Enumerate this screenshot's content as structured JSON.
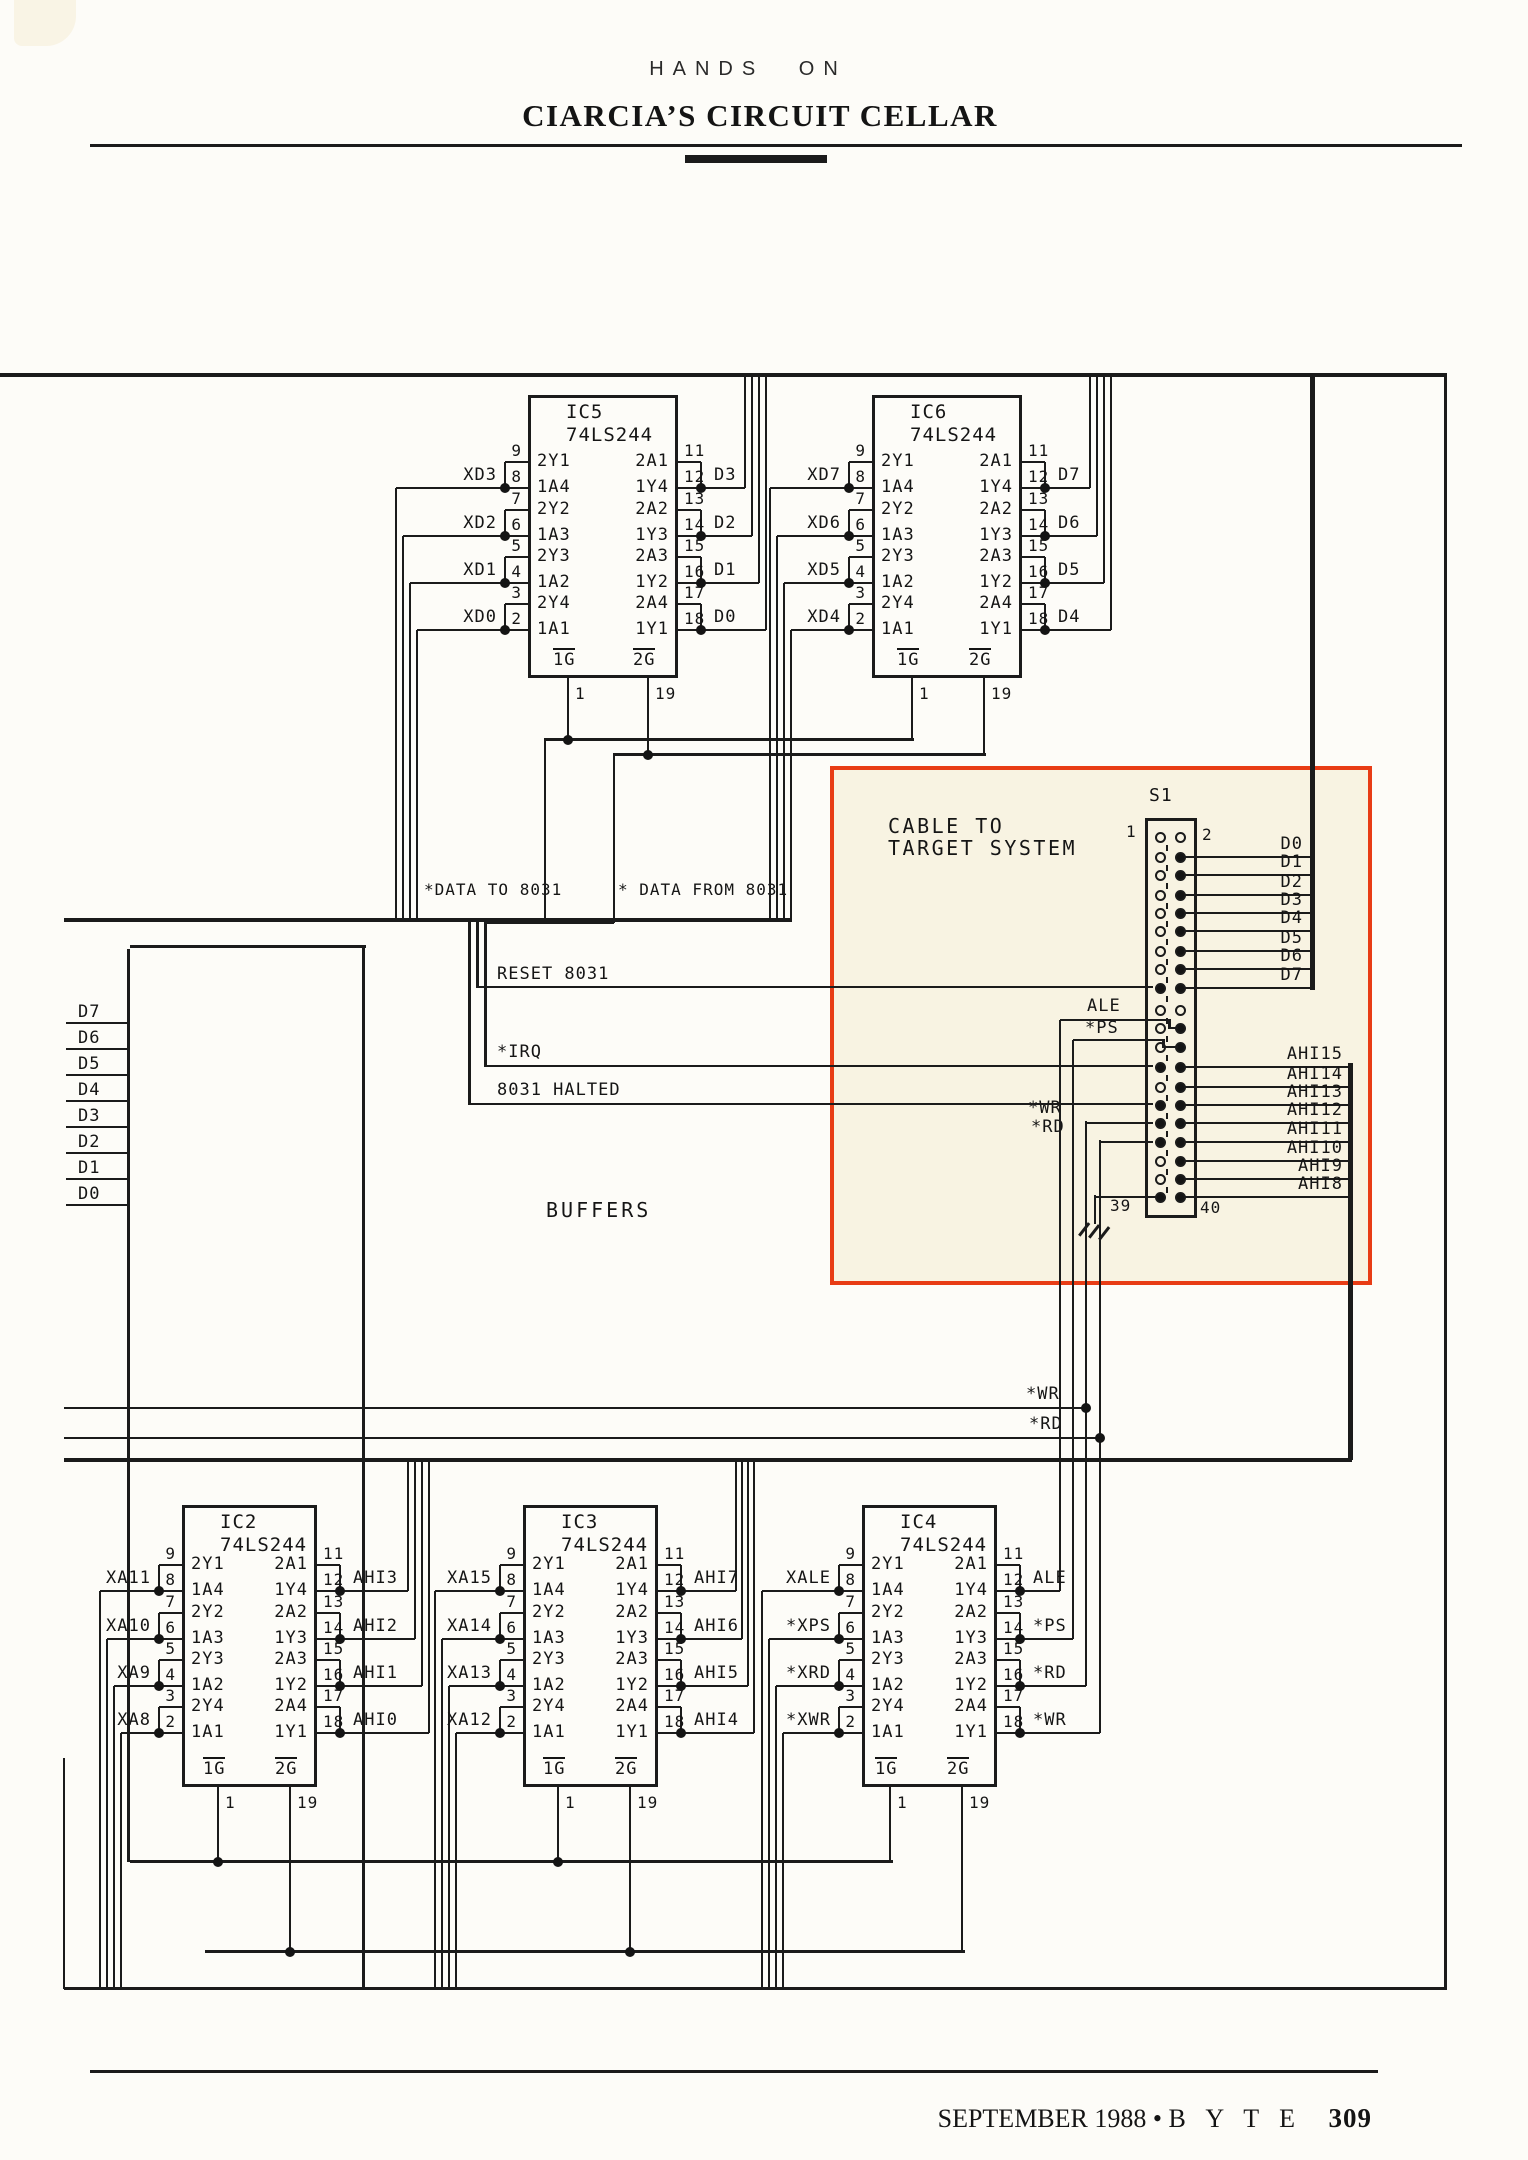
{
  "page": {
    "kicker": "HANDS ON",
    "title": "CIARCIA’S CIRCUIT CELLAR",
    "footer": {
      "issue": "SEPTEMBER 1988",
      "separator": "•",
      "magazine": "B Y T E",
      "page_number": "309"
    }
  },
  "colors": {
    "paper": "#fdfcf8",
    "ink": "#1b1b1b",
    "highlight_border": "#e83c15",
    "highlight_fill": "#f8f3e2"
  },
  "schematic": {
    "section_label": "BUFFERS",
    "highlight_caption_line1": "CABLE TO",
    "highlight_caption_line2": "TARGET SYSTEM",
    "connector": {
      "name": "S1",
      "pin_labels": {
        "p1": "1",
        "p2": "2",
        "p39": "39",
        "p40": "40"
      },
      "data_signals": [
        "D0",
        "D1",
        "D2",
        "D3",
        "D4",
        "D5",
        "D6",
        "D7"
      ],
      "address_signals": [
        "AHI15",
        "AHI14",
        "AHI13",
        "AHI12",
        "AHI11",
        "AHI10",
        "AHI9",
        "AHI8"
      ]
    },
    "signals": {
      "data_to": "*DATA TO 8031",
      "data_from": "* DATA FROM 8031",
      "reset": "RESET 8031",
      "irq": "*IRQ",
      "halted": "8031 HALTED",
      "ale": "ALE",
      "ps": "*PS",
      "wr": "*WR",
      "rd": "*RD",
      "wr_bus": "*WR",
      "rd_bus": "*RD"
    },
    "left_bus": [
      "D7",
      "D6",
      "D5",
      "D4",
      "D3",
      "D2",
      "D1",
      "D0"
    ],
    "chip_pins": {
      "left_labels": [
        "2Y1",
        "1A4",
        "2Y2",
        "1A3",
        "2Y3",
        "1A2",
        "2Y4",
        "1A1"
      ],
      "right_labels": [
        "2A1",
        "1Y4",
        "2A2",
        "1Y3",
        "2A3",
        "1Y2",
        "2A4",
        "1Y1"
      ],
      "left_numbers": [
        "9",
        "8",
        "7",
        "6",
        "5",
        "4",
        "3",
        "2"
      ],
      "right_numbers": [
        "11",
        "12",
        "13",
        "14",
        "15",
        "16",
        "17",
        "18"
      ],
      "gate_labels": [
        "1G",
        "2G"
      ],
      "gate_numbers": [
        "1",
        "19"
      ]
    },
    "chips": [
      {
        "id": "IC5",
        "part": "74LS244",
        "inputs": [
          "XD3",
          "XD2",
          "XD1",
          "XD0"
        ],
        "outputs": [
          "D3",
          "D2",
          "D1",
          "D0"
        ]
      },
      {
        "id": "IC6",
        "part": "74LS244",
        "inputs": [
          "XD7",
          "XD6",
          "XD5",
          "XD4"
        ],
        "outputs": [
          "D7",
          "D6",
          "D5",
          "D4"
        ]
      },
      {
        "id": "IC2",
        "part": "74LS244",
        "inputs": [
          "XA11",
          "XA10",
          "XA9",
          "XA8"
        ],
        "outputs": [
          "AHI3",
          "AHI2",
          "AHI1",
          "AHI0"
        ]
      },
      {
        "id": "IC3",
        "part": "74LS244",
        "inputs": [
          "XA15",
          "XA14",
          "XA13",
          "XA12"
        ],
        "outputs": [
          "AHI7",
          "AHI6",
          "AHI5",
          "AHI4"
        ]
      },
      {
        "id": "IC4",
        "part": "74LS244",
        "inputs": [
          "XALE",
          "*XPS",
          "*XRD",
          "*XWR"
        ],
        "outputs": [
          "ALE",
          "*PS",
          "*RD",
          "*WR"
        ]
      }
    ]
  }
}
